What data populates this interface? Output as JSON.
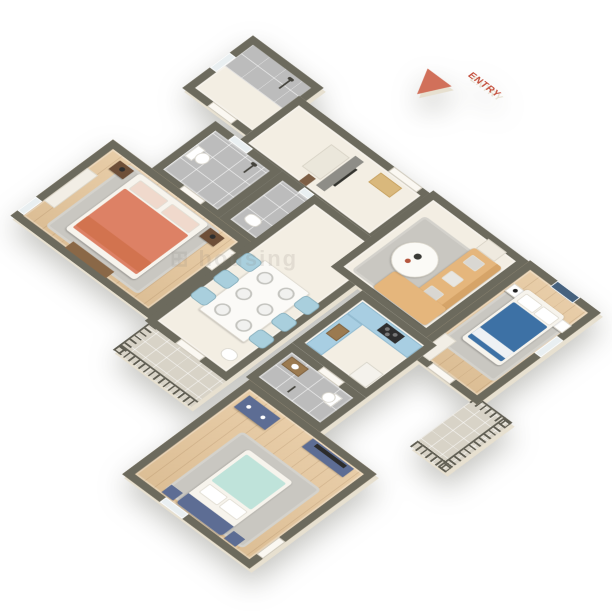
{
  "scene": {
    "title": "3D isometric apartment floor plan render",
    "background_color": "#ffffff",
    "entry_marker": {
      "label": "ENTRY",
      "color": "#d1705a"
    },
    "watermark": {
      "text": "⊞ housing",
      "opacity": 0.16
    },
    "palette": {
      "wall_top": "#6c6a5d",
      "wall_face": "#f6f1e5",
      "wood_floor": "#e3c7a0",
      "marble_floor": "#f3eee3",
      "tile_floor": "#bcbcbc",
      "balcony_floor": "#d8d3c7",
      "bed_orange": "#dd8165",
      "bed_blue": "#3d71a5",
      "bed_teal": "#bfe3da",
      "furniture_navy": "#5d6d94",
      "sofa_tan": "#e5b67c",
      "chair_lightblue": "#a9cfdd",
      "kitchen_cabinet_blue": "#a8cee2"
    },
    "rooms": [
      {
        "id": "shower-bathroom",
        "name": "Shower bathroom",
        "floor": "tile",
        "furniture": [
          "shower"
        ]
      },
      {
        "id": "foyer",
        "name": "Foyer / entry hall",
        "floor": "marble",
        "furniture": [
          "tv-panel",
          "shoe-cabinet",
          "doormat"
        ]
      },
      {
        "id": "bathroom-1",
        "name": "Bathroom 1",
        "floor": "tile",
        "furniture": [
          "toilet",
          "shower"
        ]
      },
      {
        "id": "bathroom-2",
        "name": "Bathroom 2",
        "floor": "tile",
        "furniture": [
          "washbasin",
          "shower"
        ]
      },
      {
        "id": "master-bedroom",
        "name": "Master bedroom",
        "floor": "wood",
        "furniture": [
          "double-bed-orange",
          "nightstand-x2",
          "bench",
          "wardrobe",
          "rug"
        ]
      },
      {
        "id": "hallway-dining",
        "name": "Hallway / dining",
        "floor": "marble",
        "furniture": [
          "dining-table",
          "chairs-x6",
          "washbasin"
        ]
      },
      {
        "id": "living-room",
        "name": "Living room",
        "floor": "marble",
        "furniture": [
          "l-shaped-sofa",
          "coffee-table",
          "side-table",
          "rug"
        ]
      },
      {
        "id": "bedroom-2",
        "name": "Bedroom 2",
        "floor": "wood",
        "furniture": [
          "double-bed-blue",
          "nightstand-x2",
          "wardrobe",
          "wall-art",
          "rug"
        ]
      },
      {
        "id": "kitchen",
        "name": "Kitchen",
        "floor": "marble",
        "furniture": [
          "counter-stove",
          "counter-sink",
          "fridge"
        ]
      },
      {
        "id": "bathroom-3",
        "name": "Bathroom 3",
        "floor": "tile",
        "furniture": [
          "vanity",
          "toilet",
          "shower"
        ]
      },
      {
        "id": "bedroom-3",
        "name": "Bedroom 3",
        "floor": "wood",
        "furniture": [
          "double-bed-teal",
          "dresser",
          "tv-console",
          "rug"
        ]
      },
      {
        "id": "balcony-south",
        "name": "Balcony (south)",
        "floor": "balcony",
        "furniture": [
          "railing"
        ]
      },
      {
        "id": "balcony-east",
        "name": "Balcony (east)",
        "floor": "balcony",
        "furniture": [
          "railing"
        ]
      }
    ]
  }
}
